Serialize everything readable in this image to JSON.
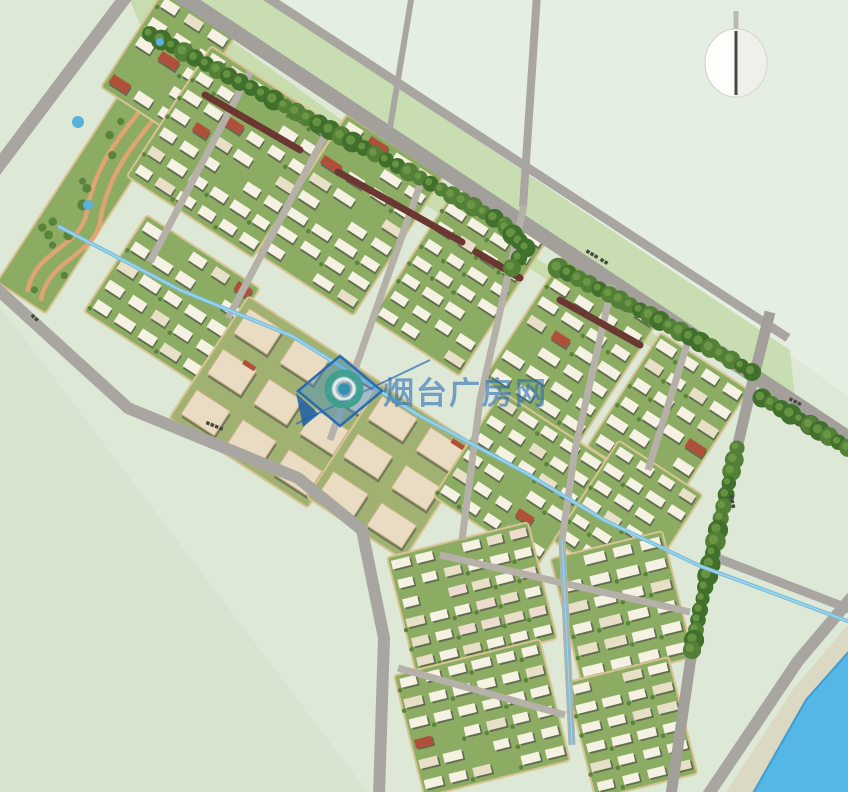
{
  "scene": {
    "width": 848,
    "height": 792,
    "description": "residential district master plan rendering"
  },
  "colors": {
    "field": "#dde8d7",
    "fieldLight": "#e4eee1",
    "fieldDark": "#d8e4d0",
    "median": "#c9ddb3",
    "verge": "#c8dcae",
    "roadMain": "#a3a09b",
    "roadMinor": "#a9a6a1",
    "roadInternal": "#b5b0a8",
    "blockGreen": "#8cab63",
    "commercialGround": "#a0b172",
    "pathTan": "#d7c493",
    "treeDark": "#41702c",
    "treeMid": "#547f37",
    "treeLight": "#6f9c49",
    "bldgWhite": "#f5f2e3",
    "bldgCream": "#e7dfc6",
    "bldgPink": "#eedcd0",
    "bldgShadow": "#50544a",
    "bldgRed": "#b1503a",
    "slab": "#eadcc3",
    "slabStroke": "#c8b387",
    "maroon": "#6b3831",
    "canal": "#79bedc",
    "canalHi": "#aadcf2",
    "river": "#55b7e6",
    "riverEdge": "#3f9ecf",
    "sand": "#dbd8c3",
    "label": "#45483f",
    "wmBlue": "#2a6cb4",
    "wmFill": "rgba(70,140,200,0.42)",
    "wmDark": "#1d5fa8",
    "ringTeal": "#3aa08c",
    "ringCore": "#2f8fae",
    "ringGap": "#e9f5f1",
    "compassFace": "#fdfdfa",
    "compassShade": "#e6e6df",
    "compassNeedle": "#47474a",
    "compassStem": "#b9b9b2",
    "landPath": "#e7a474",
    "pond": "#58b2dc"
  },
  "watermark": {
    "text": "烟台广房网",
    "logo_name": "magnifier-diamond-logo",
    "cx": 340,
    "cy": 391,
    "half": 35,
    "ring_r": 16,
    "needle": [
      [
        296,
        424
      ],
      [
        430,
        360
      ]
    ],
    "text_x": 383,
    "text_y": 404,
    "font_size": 31,
    "opacity": 0.6
  },
  "compass": {
    "cx": 736,
    "cy": 63,
    "rx": 31,
    "ry": 34
  },
  "field_patches": [
    {
      "id": "field-northeast",
      "pts": [
        [
          265,
          -5
        ],
        [
          855,
          -5
        ],
        [
          855,
          400
        ]
      ],
      "c": "fieldLight"
    },
    {
      "id": "field-southwest",
      "pts": [
        [
          -5,
          300
        ],
        [
          370,
          795
        ],
        [
          -5,
          795
        ]
      ],
      "c": "fieldDark"
    },
    {
      "id": "road-median-green",
      "pts": [
        [
          262,
          -4
        ],
        [
          790,
          350
        ],
        [
          795,
          400
        ],
        [
          186,
          -4
        ]
      ],
      "c": "median"
    },
    {
      "id": "road-verge-green",
      "pts": [
        [
          170,
          -4
        ],
        [
          505,
          238
        ],
        [
          755,
          400
        ],
        [
          748,
          410
        ],
        [
          498,
          248
        ],
        [
          148,
          42
        ],
        [
          128,
          -4
        ]
      ],
      "c": "verge"
    }
  ],
  "roads": [
    {
      "id": "road-west",
      "pts": [
        [
          128,
          -6
        ],
        [
          -6,
          172
        ]
      ],
      "w": 13,
      "c": "roadMinor"
    },
    {
      "id": "road-southwest-boundary",
      "pts": [
        [
          -6,
          286
        ],
        [
          128,
          408
        ],
        [
          298,
          478
        ],
        [
          362,
          530
        ],
        [
          384,
          638
        ],
        [
          379,
          795
        ]
      ],
      "w": 12,
      "c": "roadMinor"
    },
    {
      "id": "road-top-upper",
      "pts": [
        [
          262,
          -6
        ],
        [
          788,
          338
        ]
      ],
      "w": 9,
      "c": "roadMinor"
    },
    {
      "id": "road-top-main",
      "pts": [
        [
          178,
          -6
        ],
        [
          854,
          442
        ]
      ],
      "w": 15,
      "c": "roadMain"
    },
    {
      "id": "road-north-spur-a",
      "pts": [
        [
          412,
          -6
        ],
        [
          390,
          128
        ]
      ],
      "w": 6,
      "c": "roadMinor"
    },
    {
      "id": "road-north-spur-b",
      "pts": [
        [
          537,
          -6
        ],
        [
          523,
          207
        ]
      ],
      "w": 8,
      "c": "roadMinor"
    },
    {
      "id": "road-east-boundary",
      "pts": [
        [
          770,
          312
        ],
        [
          755,
          372
        ],
        [
          736,
          452
        ],
        [
          710,
          556
        ],
        [
          690,
          664
        ],
        [
          671,
          795
        ]
      ],
      "w": 11,
      "c": "roadMain"
    },
    {
      "id": "road-river-branch",
      "pts": [
        [
          712,
          556
        ],
        [
          852,
          610
        ]
      ],
      "w": 9,
      "c": "roadMinor"
    },
    {
      "id": "road-riverside",
      "pts": [
        [
          852,
          597
        ],
        [
          798,
          661
        ],
        [
          708,
          795
        ]
      ],
      "w": 12,
      "c": "roadMinor"
    }
  ],
  "internal_roads": [
    {
      "pts": [
        [
          250,
          72
        ],
        [
          150,
          262
        ]
      ]
    },
    {
      "pts": [
        [
          332,
          122
        ],
        [
          228,
          318
        ]
      ]
    },
    {
      "pts": [
        [
          420,
          185
        ],
        [
          330,
          440
        ]
      ]
    },
    {
      "pts": [
        [
          524,
          205
        ],
        [
          480,
          400
        ],
        [
          462,
          540
        ]
      ]
    },
    {
      "pts": [
        [
          612,
          285
        ],
        [
          575,
          450
        ],
        [
          562,
          540
        ]
      ]
    },
    {
      "pts": [
        [
          690,
          335
        ],
        [
          648,
          470
        ]
      ]
    },
    {
      "pts": [
        [
          440,
          555
        ],
        [
          690,
          612
        ]
      ]
    },
    {
      "pts": [
        [
          398,
          668
        ],
        [
          565,
          715
        ]
      ]
    },
    {
      "pts": [
        [
          562,
          540
        ],
        [
          572,
          745
        ]
      ]
    }
  ],
  "tree_strips": [
    {
      "pts": [
        [
          150,
          34
        ],
        [
          240,
          82
        ],
        [
          330,
          130
        ],
        [
          420,
          178
        ],
        [
          505,
          224
        ]
      ]
    },
    {
      "pts": [
        [
          558,
          268
        ],
        [
          630,
          305
        ],
        [
          700,
          342
        ],
        [
          752,
          372
        ]
      ]
    },
    {
      "pts": [
        [
          737,
          448
        ],
        [
          718,
          530
        ],
        [
          700,
          610
        ],
        [
          692,
          650
        ]
      ]
    },
    {
      "pts": [
        [
          762,
          398
        ],
        [
          810,
          425
        ],
        [
          848,
          448
        ]
      ]
    },
    {
      "pts": [
        [
          506,
          228
        ],
        [
          526,
          248
        ],
        [
          512,
          268
        ]
      ]
    }
  ],
  "maroon_strips": [
    {
      "pts": [
        [
          205,
          95
        ],
        [
          300,
          150
        ]
      ]
    },
    {
      "pts": [
        [
          338,
          172
        ],
        [
          462,
          242
        ]
      ]
    },
    {
      "pts": [
        [
          476,
          252
        ],
        [
          520,
          278
        ]
      ]
    },
    {
      "pts": [
        [
          560,
          300
        ],
        [
          640,
          345
        ]
      ]
    }
  ],
  "canals": [
    {
      "id": "canal-main",
      "pts": [
        [
          58,
          226
        ],
        [
          180,
          290
        ],
        [
          292,
          336
        ],
        [
          420,
          416
        ],
        [
          524,
          472
        ],
        [
          604,
          520
        ],
        [
          700,
          566
        ],
        [
          770,
          592
        ],
        [
          850,
          622
        ]
      ],
      "w": 4
    },
    {
      "id": "canal-south",
      "pts": [
        [
          562,
          540
        ],
        [
          572,
          745
        ]
      ],
      "w": 3
    }
  ],
  "ponds": [
    [
      78,
      122,
      6
    ],
    [
      88,
      205,
      5
    ],
    [
      160,
      42,
      4
    ]
  ],
  "water": {
    "river_pts": [
      [
        852,
        648
      ],
      [
        806,
        700
      ],
      [
        752,
        795
      ],
      [
        852,
        795
      ]
    ],
    "sand_pts": [
      [
        852,
        620
      ],
      [
        794,
        688
      ],
      [
        724,
        795
      ],
      [
        758,
        795
      ],
      [
        812,
        706
      ],
      [
        852,
        656
      ]
    ]
  },
  "blocks": [
    {
      "id": "park-strip",
      "cx": 103,
      "cy": 172,
      "w": 58,
      "h": 300,
      "rot": 33,
      "type": "landscape",
      "seed": 7
    },
    {
      "id": "block-nw",
      "cx": 168,
      "cy": 62,
      "w": 85,
      "h": 115,
      "rot": 33,
      "type": "res",
      "palette": "white",
      "seed": 11
    },
    {
      "id": "block-a1",
      "cx": 232,
      "cy": 152,
      "w": 150,
      "h": 155,
      "rot": 33,
      "type": "res",
      "palette": "white",
      "seed": 23
    },
    {
      "id": "block-a2",
      "cx": 350,
      "cy": 215,
      "w": 115,
      "h": 165,
      "rot": 33,
      "type": "res",
      "palette": "white",
      "seed": 37
    },
    {
      "id": "block-a3",
      "cx": 460,
      "cy": 278,
      "w": 105,
      "h": 165,
      "rot": 33,
      "type": "res",
      "palette": "white",
      "seed": 41
    },
    {
      "id": "block-a4",
      "cx": 572,
      "cy": 348,
      "w": 115,
      "h": 150,
      "rot": 33,
      "type": "res",
      "palette": "white",
      "seed": 53
    },
    {
      "id": "block-a5",
      "cx": 668,
      "cy": 418,
      "w": 105,
      "h": 135,
      "rot": 33,
      "type": "res",
      "palette": "white",
      "seed": 61
    },
    {
      "id": "block-b1",
      "cx": 172,
      "cy": 300,
      "w": 135,
      "h": 115,
      "rot": 33,
      "type": "res",
      "palette": "white",
      "seed": 71
    },
    {
      "id": "school-west",
      "cx": 278,
      "cy": 402,
      "w": 165,
      "h": 145,
      "rot": 33,
      "type": "comm",
      "seed": 83
    },
    {
      "id": "school-east",
      "cx": 392,
      "cy": 472,
      "w": 115,
      "h": 135,
      "rot": 33,
      "type": "comm",
      "seed": 89
    },
    {
      "id": "block-b2",
      "cx": 520,
      "cy": 478,
      "w": 125,
      "h": 125,
      "rot": 33,
      "type": "res",
      "palette": "white",
      "seed": 97
    },
    {
      "id": "block-b3",
      "cx": 628,
      "cy": 518,
      "w": 100,
      "h": 120,
      "rot": 33,
      "type": "res",
      "palette": "white",
      "seed": 103
    },
    {
      "id": "block-s1",
      "cx": 472,
      "cy": 598,
      "w": 145,
      "h": 120,
      "rot": -14,
      "type": "res",
      "palette": "cream",
      "seed": 113
    },
    {
      "id": "block-s2",
      "cx": 622,
      "cy": 608,
      "w": 115,
      "h": 130,
      "rot": -14,
      "type": "res",
      "palette": "white",
      "seed": 127
    },
    {
      "id": "block-s3",
      "cx": 482,
      "cy": 718,
      "w": 150,
      "h": 125,
      "rot": -14,
      "type": "res",
      "palette": "white",
      "seed": 131
    },
    {
      "id": "block-s4",
      "cx": 632,
      "cy": 728,
      "w": 105,
      "h": 120,
      "rot": -14,
      "type": "res",
      "palette": "white",
      "seed": 139
    }
  ],
  "labels": [
    {
      "text": "▪▪▪ ▪▪",
      "x": 585,
      "y": 252,
      "rot": 31
    },
    {
      "text": "▪▪",
      "x": 30,
      "y": 316,
      "rot": 42
    },
    {
      "text": "▪▪▪▪",
      "x": 205,
      "y": 424,
      "rot": 22
    },
    {
      "text": "▪▪▪",
      "x": 729,
      "y": 495,
      "rot": 78
    },
    {
      "text": "▪▪▪",
      "x": 788,
      "y": 400,
      "rot": 27
    }
  ]
}
